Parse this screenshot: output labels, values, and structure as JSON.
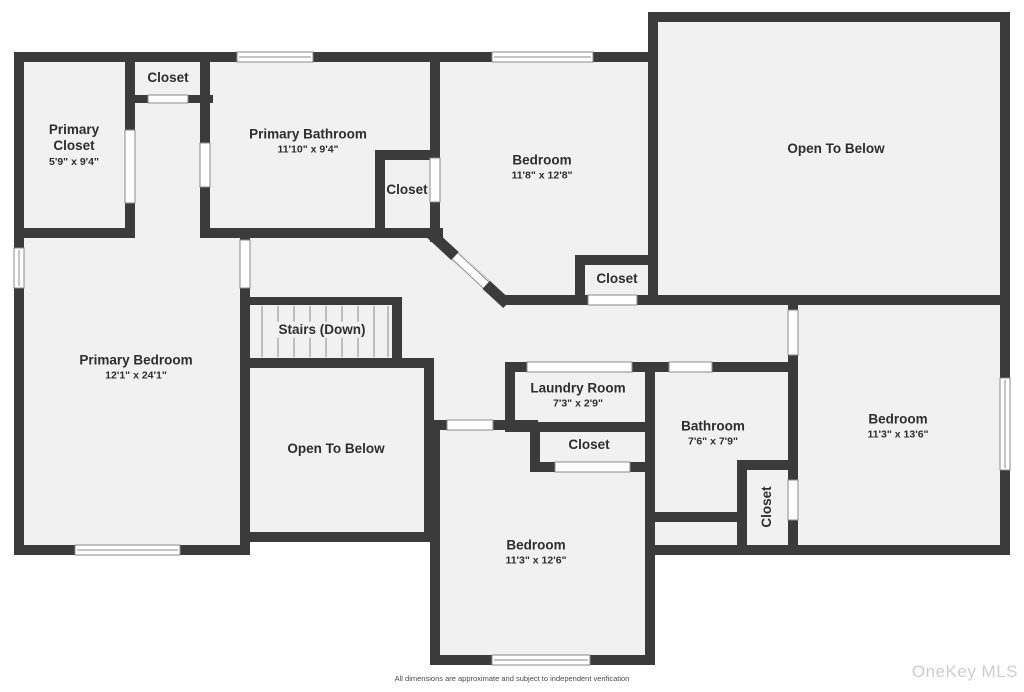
{
  "plan": {
    "rooms": [
      {
        "id": "primary-closet",
        "name": "Primary Closet",
        "dims": "5'9\" x 9'4\""
      },
      {
        "id": "closet-top",
        "name": "Closet",
        "dims": ""
      },
      {
        "id": "primary-bathroom",
        "name": "Primary Bathroom",
        "dims": "11'10\" x 9'4\""
      },
      {
        "id": "bathroom-closet",
        "name": "Closet",
        "dims": ""
      },
      {
        "id": "bedroom-top",
        "name": "Bedroom",
        "dims": "11'8\" x 12'8\""
      },
      {
        "id": "open-to-below-top",
        "name": "Open To Below",
        "dims": ""
      },
      {
        "id": "hall-closet",
        "name": "Closet",
        "dims": ""
      },
      {
        "id": "primary-bedroom",
        "name": "Primary Bedroom",
        "dims": "12'1\" x 24'1\""
      },
      {
        "id": "stairs",
        "name": "Stairs (Down)",
        "dims": ""
      },
      {
        "id": "open-to-below-mid",
        "name": "Open To Below",
        "dims": ""
      },
      {
        "id": "laundry-room",
        "name": "Laundry Room",
        "dims": "7'3\" x 2'9\""
      },
      {
        "id": "bedroom-closet",
        "name": "Closet",
        "dims": ""
      },
      {
        "id": "bathroom",
        "name": "Bathroom",
        "dims": "7'6\" x 7'9\""
      },
      {
        "id": "bathroom-closet-2",
        "name": "Closet",
        "dims": ""
      },
      {
        "id": "bedroom-right",
        "name": "Bedroom",
        "dims": "11'3\" x 13'6\""
      },
      {
        "id": "bedroom-bottom",
        "name": "Bedroom",
        "dims": "11'3\" x 12'6\""
      }
    ],
    "footer": {
      "disclaimer": "All dimensions are approximate and subject to independent verification",
      "watermark": "OneKey MLS"
    },
    "colors": {
      "wall": "#3b3b3b",
      "floor": "#f1f1f1",
      "background": "#ffffff",
      "opening_outline": "#8a8a8a",
      "stair_tread": "#adadad",
      "label_text": "#2e2e2e",
      "watermark_text": "#cdcdcd"
    }
  }
}
